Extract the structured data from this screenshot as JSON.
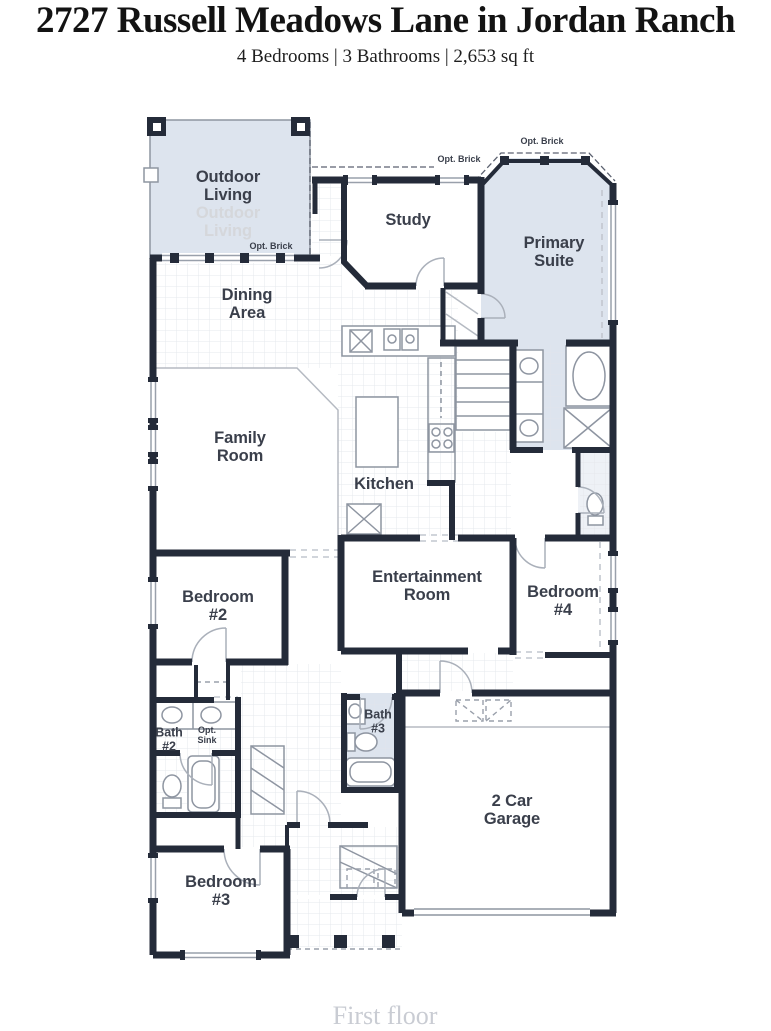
{
  "header": {
    "title": "2727 Russell Meadows Lane in Jordan Ranch",
    "subtitle": "4 Bedrooms | 3 Bathrooms | 2,653 sq ft"
  },
  "floorplan": {
    "caption": "First floor",
    "colors": {
      "wall": "#242b39",
      "shaded_room": "#dde4ee",
      "tile_grid": "#e4e7eb",
      "label_text": "#3a3f4b",
      "ghost_text": "#d5d7db",
      "caption_text": "#c9ccd3"
    },
    "rooms": {
      "outdoor_living": "Outdoor\nLiving",
      "outdoor_living_ghost": "Outdoor\nLiving",
      "study": "Study",
      "primary_suite": "Primary\nSuite",
      "dining_area": "Dining\nArea",
      "family_room": "Family\nRoom",
      "kitchen": "Kitchen",
      "entertainment_room": "Entertainment\nRoom",
      "bedroom_2": "Bedroom\n#2",
      "bedroom_4": "Bedroom\n#4",
      "bath_2": "Bath\n#2",
      "bath_3": "Bath\n#3",
      "bedroom_3": "Bedroom\n#3",
      "garage": "2 Car\nGarage"
    },
    "annotations": {
      "opt_brick_porch": "Opt. Brick",
      "opt_brick_study": "Opt. Brick",
      "opt_brick_bay": "Opt. Brick",
      "opt_sink": "Opt.\nSink"
    }
  }
}
